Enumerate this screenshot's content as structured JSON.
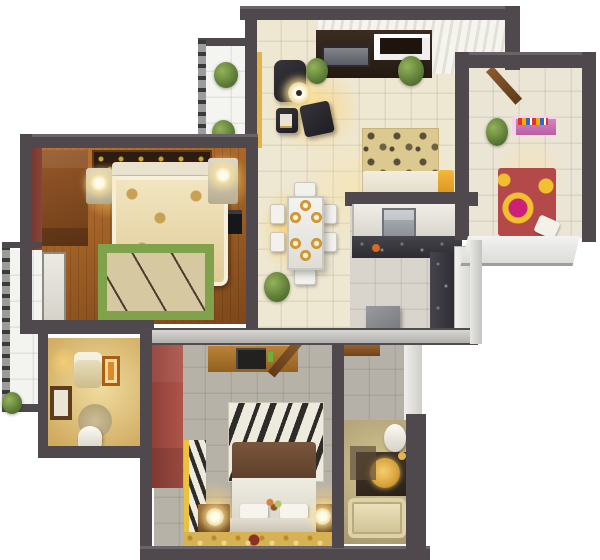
{
  "meta": {
    "type": "3d-apartment-floor-plan-top-view",
    "background": "#ffffff"
  },
  "palette": {
    "wall_dark": "#4f494e",
    "wall_light": "#c6c4c0",
    "wood_floor": "#a9652a",
    "maroon_wall": "#7c3a31",
    "red_wardrobe": "#a04a41",
    "warm_glow": "#ffd36e",
    "living_floor": "#eee5cc",
    "gray_floor": "#b7b2a8",
    "kids_bed_red": "#b34a49",
    "kids_bed_yellow": "#f0c030",
    "kids_bed_magenta": "#cc2077",
    "pink_shelf": "#c977b5",
    "green_rug": "#7fa24a",
    "gold_carpet": "#d7b254",
    "counter_dark": "#3c3a40",
    "sofa_cream": "#efe9da",
    "accent_yellow": "#e2b445"
  },
  "rooms": [
    {
      "name": "living-room",
      "furniture": [
        "media-wall",
        "tv",
        "shelf-photos",
        "armchair",
        "floor-lamp",
        "side-table",
        "ottoman",
        "leopard-rug",
        "cream-sofa",
        "yellow-throw",
        "plants"
      ]
    },
    {
      "name": "kids-bedroom",
      "furniture": [
        "pink-bookshelf",
        "circle-pattern-bed",
        "pillow",
        "plant",
        "open-door"
      ]
    },
    {
      "name": "master-bedroom",
      "furniture": [
        "ornate-rug",
        "double-bed",
        "tufted-headboard",
        "nightstand-left",
        "nightstand-right",
        "bedside-lamps",
        "green-border-rug",
        "wardrobe",
        "wall-tv",
        "balcony-door"
      ]
    },
    {
      "name": "dining-area",
      "furniture": [
        "dining-table",
        "six-plates",
        "six-chairs",
        "potted-plant"
      ]
    },
    {
      "name": "kitchen",
      "furniture": [
        "upper-cabinets",
        "stove",
        "l-counter-dark",
        "fridge",
        "stool"
      ]
    },
    {
      "name": "bathroom-main",
      "furniture": [
        "vanity-sink",
        "orange-mirror",
        "window-frame",
        "oval-rug",
        "toilet"
      ]
    },
    {
      "name": "bedroom-two",
      "furniture": [
        "red-wardrobe",
        "zebra-cabinet",
        "tv-console",
        "tv",
        "zebra-rug",
        "bed-brown-blanket",
        "pillows",
        "headboard",
        "nightstands",
        "round-lamps",
        "gold-carpet",
        "open-door"
      ]
    },
    {
      "name": "bathroom-ensuite",
      "furniture": [
        "toilet",
        "dark-vanity",
        "gold-basin",
        "bathtub"
      ]
    },
    {
      "name": "balcony-top",
      "furniture": [
        "railing",
        "plants"
      ]
    },
    {
      "name": "balcony-left",
      "furniture": [
        "railing",
        "plant"
      ]
    },
    {
      "name": "hallway",
      "furniture": [
        "wood-shelf"
      ]
    }
  ]
}
